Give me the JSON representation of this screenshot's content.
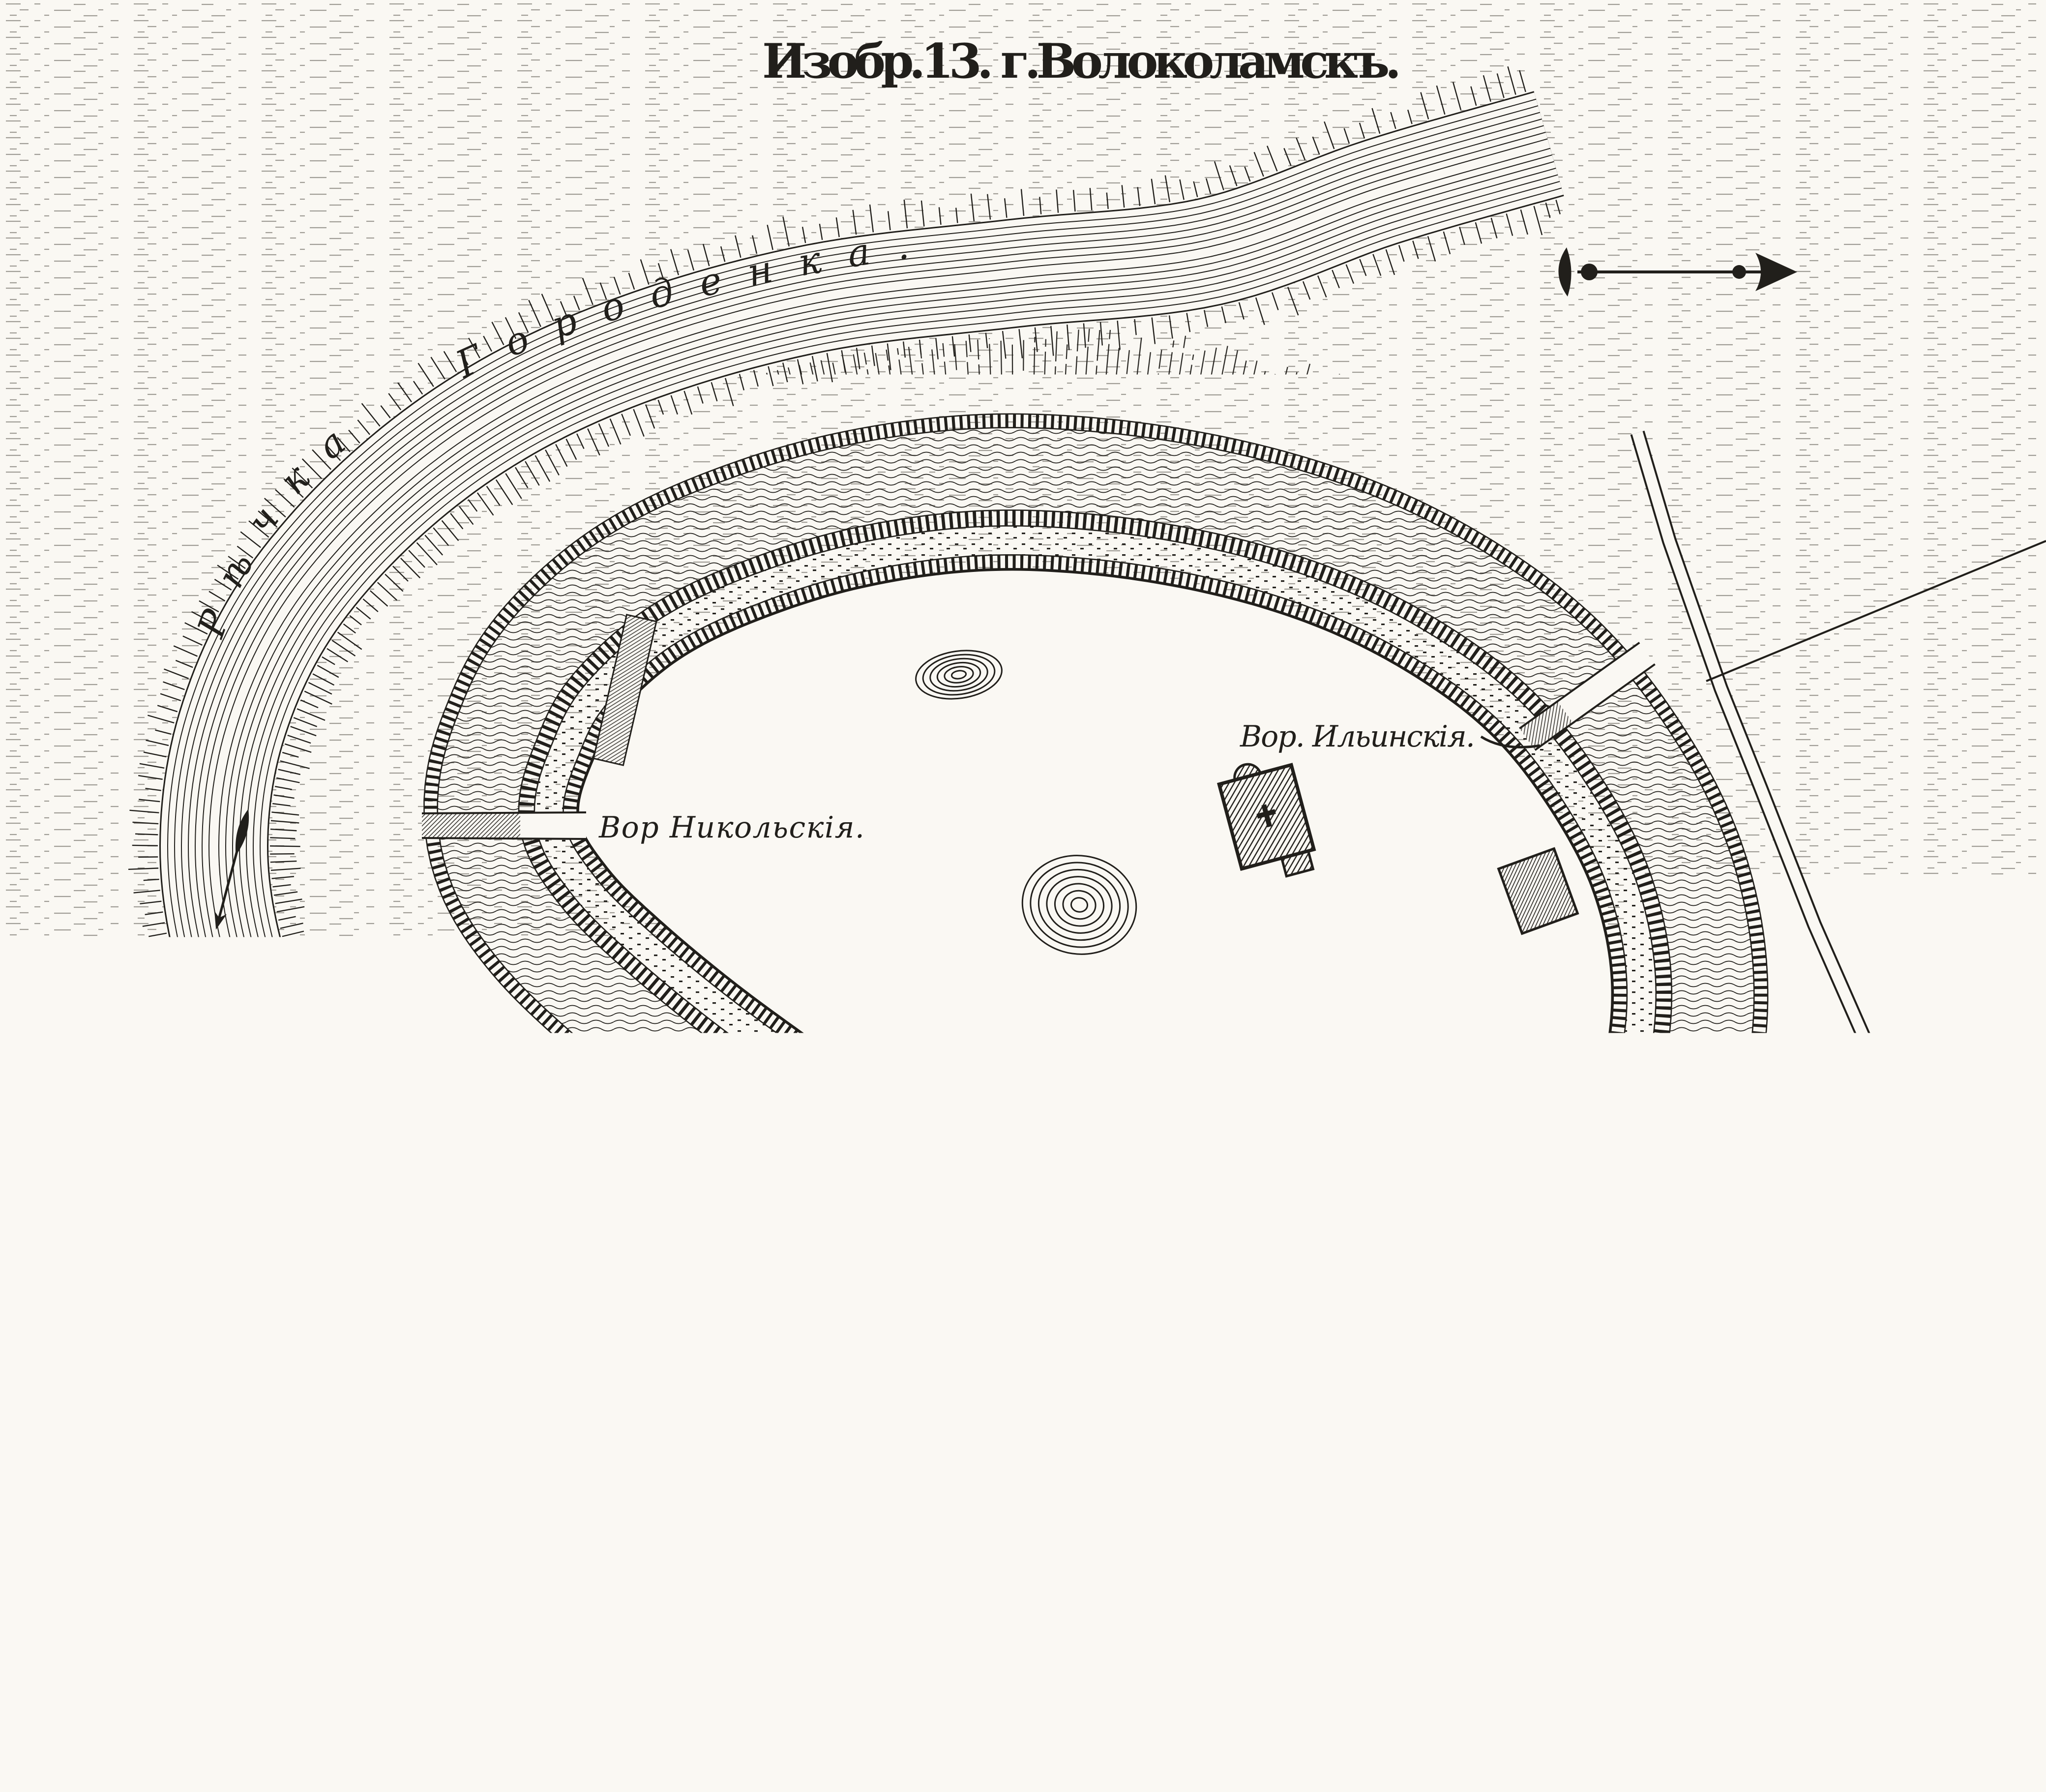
{
  "document": {
    "type": "engraved-fortress-plan",
    "title": "Изобр.13.  г.Волоколамскъ.",
    "labels": {
      "river": "Рѣчка Городенка.",
      "gate_west": "Вор Никольскія.",
      "gate_northeast": "Вор. Ильинскія.",
      "source_caption": "Изъ Архива Инженернаго Департамента."
    },
    "features": [
      {
        "name": "river-gorodenka",
        "kind": "river"
      },
      {
        "name": "flow-arrow",
        "kind": "stream-direction-marker"
      },
      {
        "name": "river-ford",
        "kind": "crossing-over-river"
      },
      {
        "name": "moat",
        "kind": "water-ditch-around-fortress"
      },
      {
        "name": "rampart-bands",
        "kind": "fortification-scarps"
      },
      {
        "name": "inner-plateau",
        "kind": "fortress-yard"
      },
      {
        "name": "church-with-cross",
        "kind": "building"
      },
      {
        "name": "storehouse",
        "kind": "building"
      },
      {
        "name": "mound-small",
        "kind": "contoured-hillock"
      },
      {
        "name": "mound-large",
        "kind": "contoured-hillock"
      },
      {
        "name": "causeway-nikolskaya",
        "kind": "gate-bridge"
      },
      {
        "name": "causeway-ilyinskaya",
        "kind": "gate-bridge"
      },
      {
        "name": "causeway-northwest-ramp",
        "kind": "gate-bridge"
      },
      {
        "name": "road-northeast",
        "kind": "road"
      },
      {
        "name": "boundary-line",
        "kind": "straight-field-line"
      },
      {
        "name": "north-arrow",
        "kind": "compass-arrow-pointing-right"
      }
    ],
    "colors": {
      "ink": "#211f1b",
      "paper": "#faf8f3"
    }
  }
}
